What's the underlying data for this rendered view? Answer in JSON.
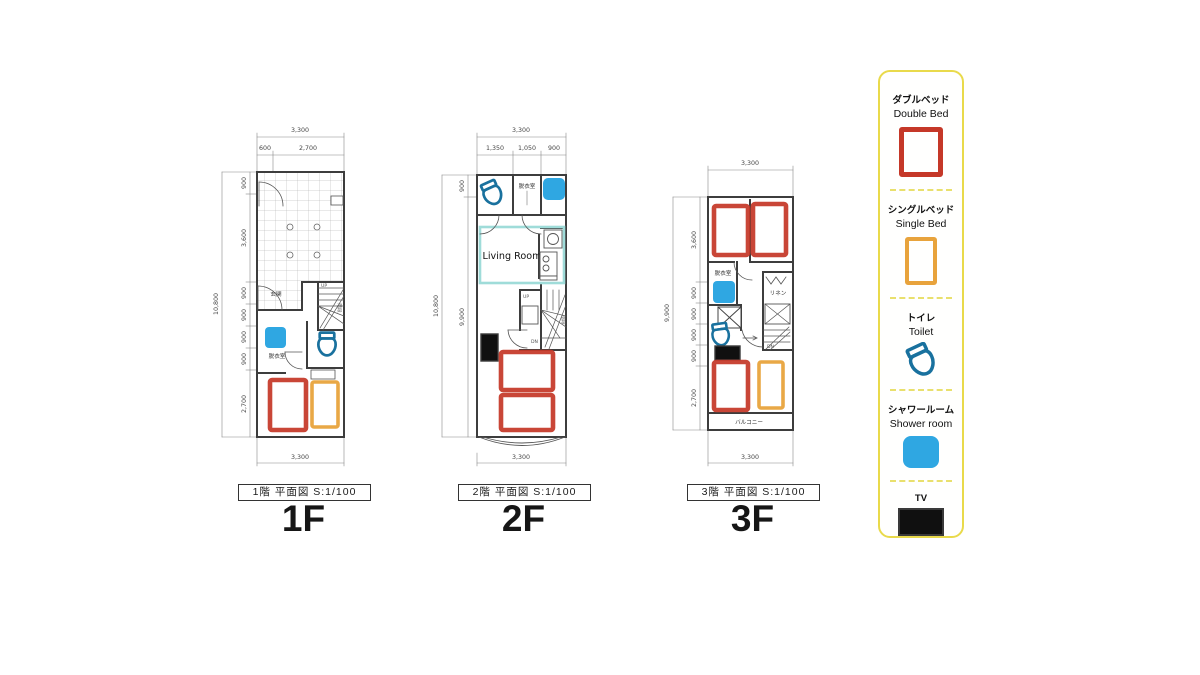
{
  "floors": [
    {
      "id": "1F",
      "caption": "1階 平面図 S:1/100",
      "big_label": "1F",
      "rooms": {
        "entrance": "玄関",
        "dressing": "脱衣室",
        "stairs": "階段",
        "up": "UP"
      },
      "dims": {
        "top_total": "3,300",
        "top_segments": [
          "600",
          "2,700"
        ],
        "left_total": "10,800",
        "left_segments": [
          "900",
          "3,600",
          "900",
          "900",
          "900",
          "900",
          "2,700"
        ],
        "bottom_total": "3,300"
      }
    },
    {
      "id": "2F",
      "caption": "2階 平面図 S:1/100",
      "big_label": "2F",
      "rooms": {
        "dressing": "脱衣室",
        "living": "Living Room",
        "stairs": "階段",
        "up": "UP",
        "down": "DN"
      },
      "dims": {
        "top_total": "3,300",
        "top_segments": [
          "1,350",
          "1,050",
          "900"
        ],
        "left_total": "10,800",
        "left_segments": [
          "900",
          "9,900"
        ],
        "bottom_total": "3,300"
      }
    },
    {
      "id": "3F",
      "caption": "3階 平面図 S:1/100",
      "big_label": "3F",
      "rooms": {
        "dressing": "脱衣室",
        "linen": "リネン",
        "balcony": "バルコニー",
        "down": "DN"
      },
      "dims": {
        "top_total": "3,300",
        "left_total": "9,900",
        "left_segments": [
          "3,600",
          "900",
          "900",
          "900",
          "900",
          "2,700"
        ],
        "bottom_total": "3,300"
      }
    }
  ],
  "legend": {
    "items": [
      {
        "jp": "ダブルベッド",
        "en": "Double Bed",
        "icon": "double-bed-icon",
        "color": "#c53828"
      },
      {
        "jp": "シングルベッド",
        "en": "Single Bed",
        "icon": "single-bed-icon",
        "color": "#e8a33c"
      },
      {
        "jp": "トイレ",
        "en": "Toilet",
        "icon": "toilet-icon",
        "color": "#19719e"
      },
      {
        "jp": "シャワールーム",
        "en": "Shower room",
        "icon": "shower-icon",
        "color": "#2fa7e2"
      },
      {
        "jp": "TV",
        "en": "",
        "icon": "tv-icon",
        "color": "#101010"
      }
    ]
  },
  "colors": {
    "double_bed": "#c53828",
    "single_bed": "#e8a33c",
    "toilet": "#19719e",
    "shower": "#2fa7e2",
    "tv": "#101010",
    "legend_border": "#e9da4b",
    "living_outline": "#9fdcd9"
  }
}
